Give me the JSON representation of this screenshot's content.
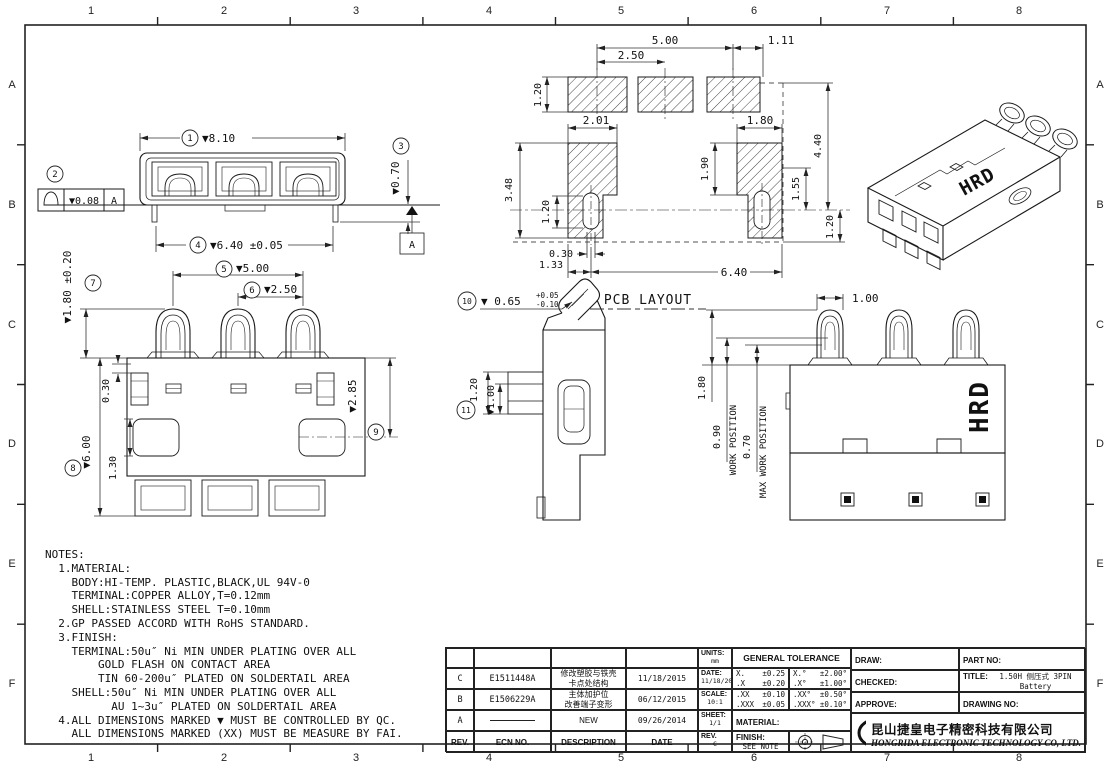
{
  "border": {
    "cols": [
      "1",
      "2",
      "3",
      "4",
      "5",
      "6",
      "7",
      "8"
    ],
    "rows": [
      "A",
      "B",
      "C",
      "D",
      "E",
      "F"
    ]
  },
  "drawing": {
    "top_view": {
      "balloon1": "1",
      "dim_width": "▼8.10",
      "balloon2": "2",
      "fcf_value": "▼0.08",
      "fcf_datum": "A",
      "balloon3": "3",
      "dim_standoff": "▼0.70",
      "balloon4": "4",
      "dim_span": "▼6.40 ±0.05",
      "datum_label": "A"
    },
    "front_view": {
      "balloon5": "5",
      "dim_pitch_outer": "▼5.00",
      "balloon6": "6",
      "dim_pitch": "▼2.50",
      "balloon7": "7",
      "dim_contact_h": "▼1.80 ±0.20",
      "balloon8": "8",
      "dim_height": "▼6.00",
      "dim_step": "0.30",
      "dim_cut": "1.30",
      "balloon9": "9",
      "dim_mid": "▼2.85"
    },
    "side_view": {
      "balloon10": "10",
      "dim_thick": "▼ 0.65",
      "tol_plus": "+0.05",
      "tol_minus": "-0.10",
      "balloon11": "11",
      "dim_tab": "1.20",
      "dim_tab2": "▼1.00"
    },
    "pcb_view": {
      "label": "PCB LAYOUT",
      "dim_a": "5.00",
      "dim_b": "1.11",
      "dim_c": "2.50",
      "dim_d": "1.20",
      "dim_e": "2.01",
      "dim_f": "1.80",
      "dim_g": "1.90",
      "dim_h": "4.40",
      "dim_i": "3.48",
      "dim_j": "1.20",
      "dim_k": "1.55",
      "dim_l": "0.30",
      "dim_m": "1.33",
      "dim_n": "6.40",
      "dim_o": "1.20"
    },
    "work_view": {
      "dim_w": "1.00",
      "dim_x": "1.80",
      "dim_y": "0.90",
      "label_y": "WORK POSITION",
      "dim_z": "0.70",
      "label_z": "MAX WORK POSITION",
      "brand": "HRD"
    },
    "iso_view": {
      "brand": "HRD"
    }
  },
  "notes": {
    "lines": [
      "NOTES:",
      "  1.MATERIAL:",
      "    BODY:HI-TEMP. PLASTIC,BLACK,UL 94V-0",
      "    TERMINAL:COPPER ALLOY,T=0.12mm",
      "    SHELL:STAINLESS STEEL T=0.10mm",
      "  2.GP PASSED ACCORD WITH RoHS STANDARD.",
      "  3.FINISH:",
      "    TERMINAL:50u″ Ni MIN UNDER PLATING OVER ALL",
      "        GOLD FLASH ON CONTACT AREA",
      "        TIN 60-200u″ PLATED ON SOLDERTAIL AREA",
      "    SHELL:50u″ Ni MIN UNDER PLATING OVER ALL",
      "          AU 1~3u″ PLATED ON SOLDERTAIL AREA",
      "  4.ALL DIMENSIONS MARKED ▼ MUST BE CONTROLLED BY QC.",
      "    ALL DIMENSIONS MARKED (XX) MUST BE MEASURE BY FAI."
    ]
  },
  "revisions": {
    "headers": {
      "rev": "REV.",
      "ecn": "ECN NO.",
      "desc": "DESCRIPTION",
      "date": "DATE"
    },
    "rows": [
      {
        "rev": "C",
        "ecn": "E1511448A",
        "desc": [
          "修改塑胶与铁壳",
          "卡点处结构"
        ],
        "date": "11/18/2015"
      },
      {
        "rev": "B",
        "ecn": "E1506229A",
        "desc": [
          "主体加护位",
          "改善端子变形"
        ],
        "date": "06/12/2015"
      },
      {
        "rev": "A",
        "ecn": "",
        "desc": [
          "NEW"
        ],
        "date": "09/26/2014"
      }
    ]
  },
  "info": {
    "units_label": "UNITS:",
    "units": "mm",
    "date_label": "DATE:",
    "date": "11/18/2015",
    "scale_label": "SCALE:",
    "scale": "10:1",
    "sheet_label": "SHEET:",
    "sheet": "1/1",
    "rev_label": "REV.",
    "rev": "C",
    "tolerance_title": "GENERAL TOLERANCE",
    "material_label": "MATERIAL:",
    "finish_label": "FINISH:",
    "finish": "SEE NOTE",
    "tol_linear": [
      [
        "X.",
        "±0.25"
      ],
      [
        ".X",
        "±0.20"
      ],
      [
        ".XX",
        "±0.10"
      ],
      [
        ".XXX",
        "±0.05"
      ]
    ],
    "tol_angular": [
      [
        "X.°",
        "±2.00°"
      ],
      [
        ".X°",
        "±1.00°"
      ],
      [
        ".XX°",
        "±0.50°"
      ],
      [
        ".XXX°",
        "±0.10°"
      ]
    ]
  },
  "titleblock": {
    "draw_label": "DRAW:",
    "part_label": "PART NO:",
    "part_no": "B30-AB03F15C",
    "checked_label": "CHECKED:",
    "title_label": "TITLE:",
    "title_lines": [
      "1.50H 侧压式 3PIN Battery",
      "2.50PITCH"
    ],
    "approve_label": "APPROVE:",
    "drawing_no_label": "DRAWING NO:",
    "company_cn": "昆山捷皇电子精密科技有限公司",
    "company_en": "HONGRIDA ELECTRONIC TECHNOLOGY CO, LTD.",
    "logo_text": "D"
  }
}
